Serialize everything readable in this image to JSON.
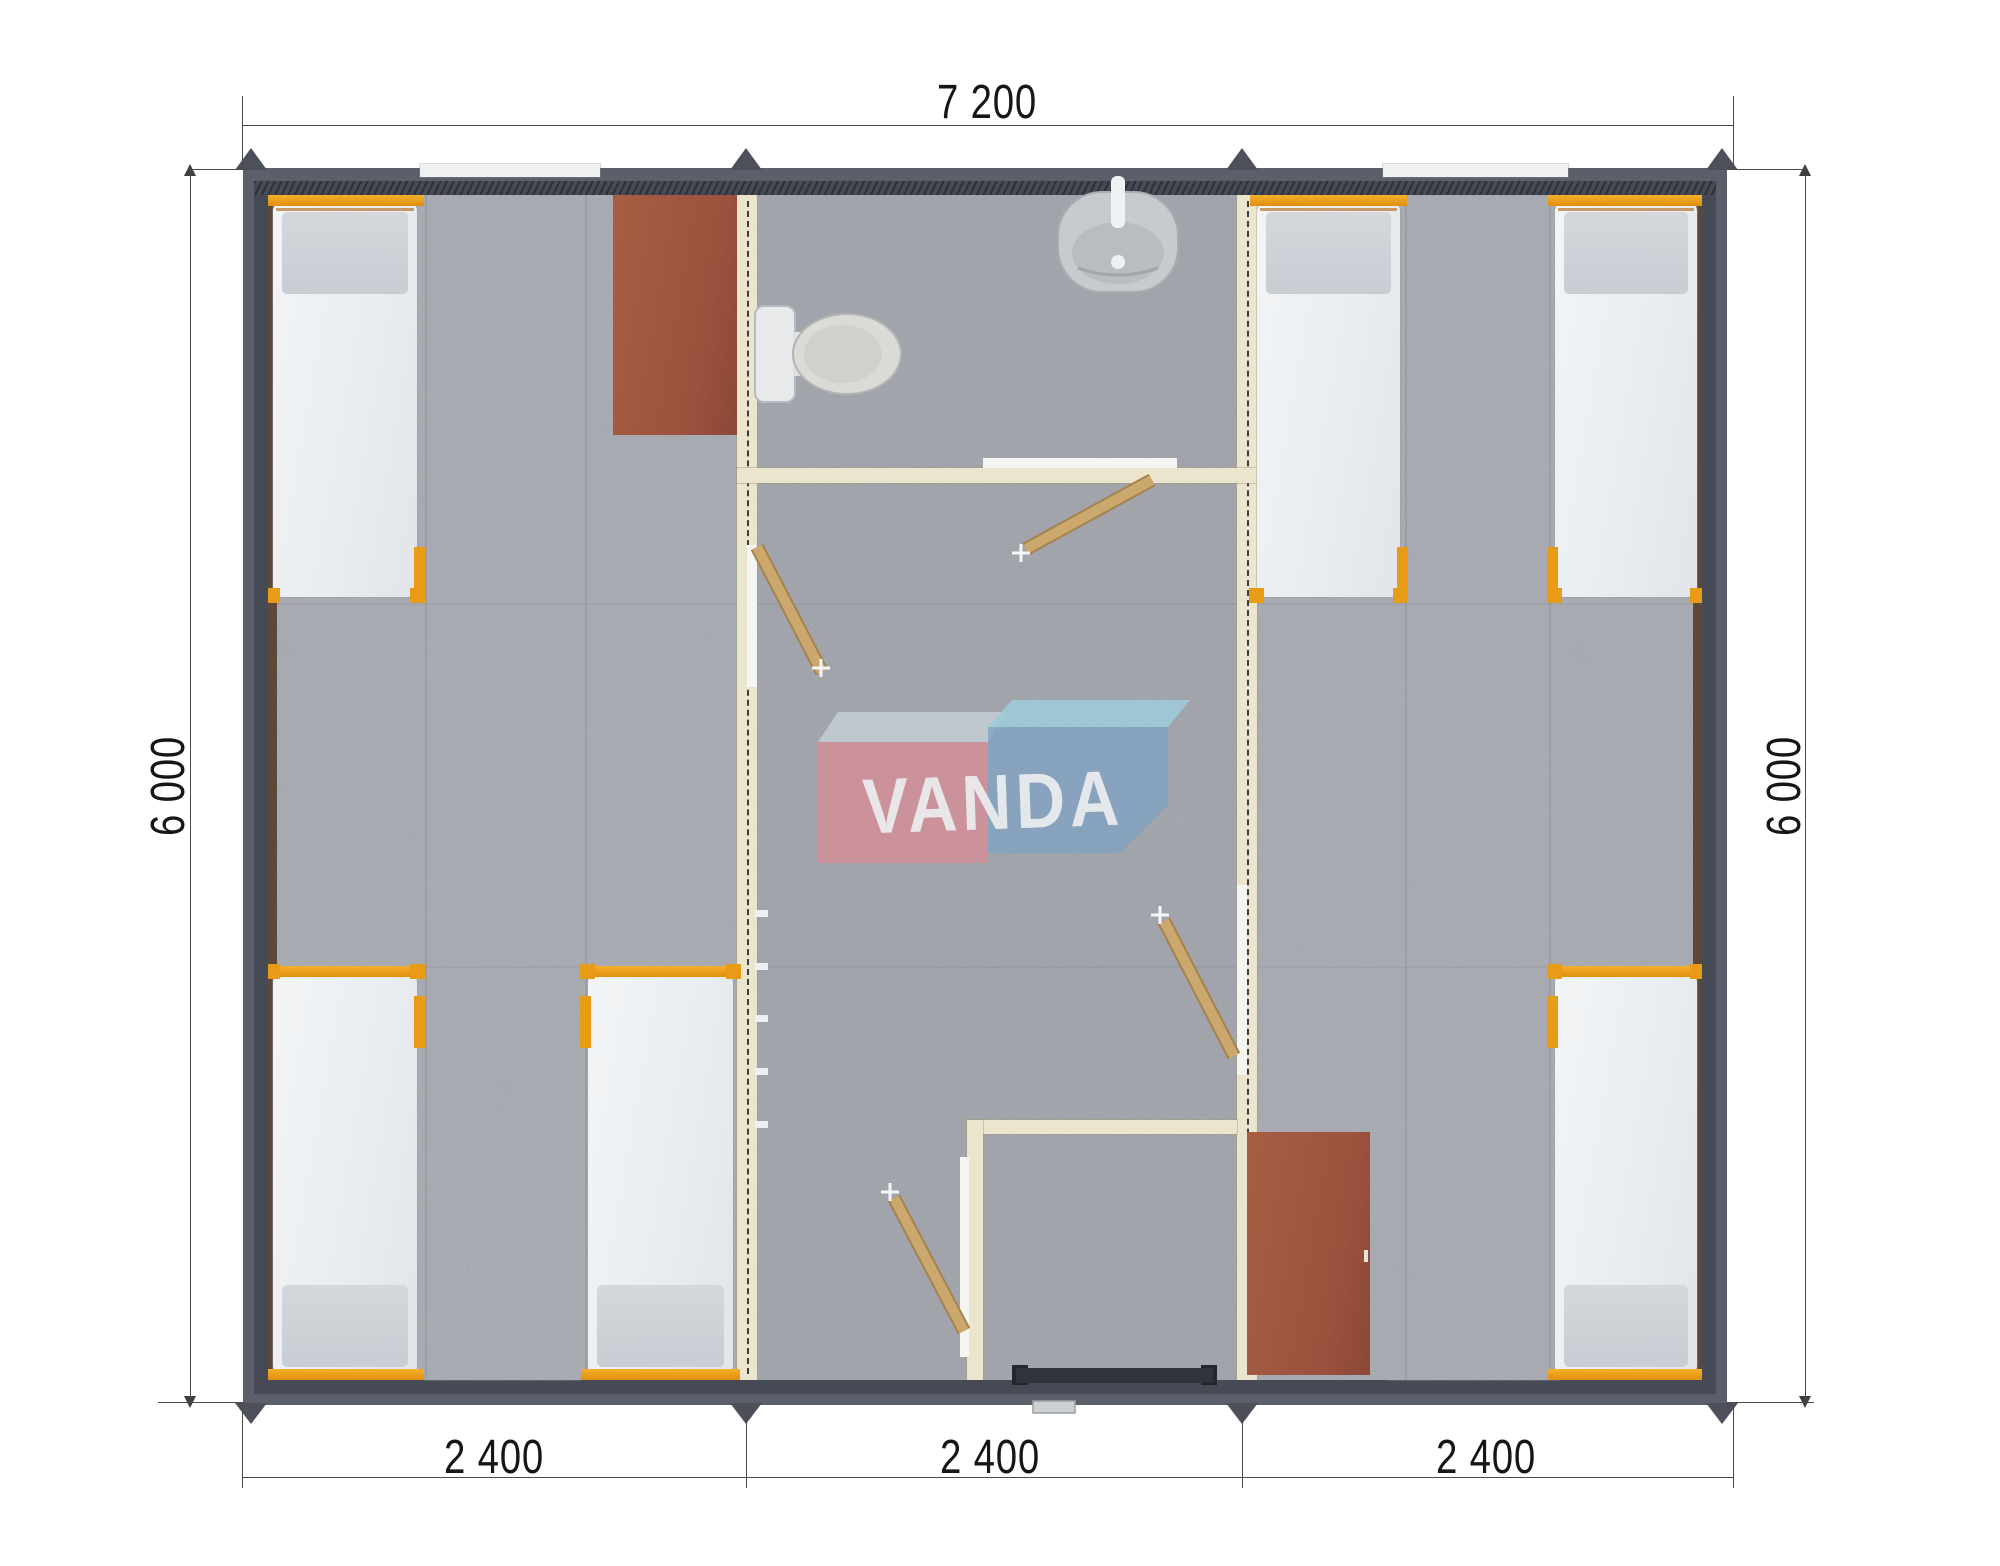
{
  "page": {
    "type": "architectural-floor-plan-top-view",
    "background": "#ffffff"
  },
  "dimensions": {
    "top_width": "7 200",
    "left_height": "6 000",
    "right_height": "6 000",
    "bottom_segments": [
      {
        "label": "2 400"
      },
      {
        "label": "2 400"
      },
      {
        "label": "2 400"
      }
    ]
  },
  "watermark": {
    "text": "VANDA",
    "red_box_color": "#dd8e99",
    "blue_box_color": "#7fa5c8",
    "blue_top_face_color": "#9ed3e6",
    "grey_top_face_color": "#cdd8de",
    "text_color": "#f9fbfc"
  },
  "colors": {
    "wall_outer": "#5a5f69",
    "wall_inner": "#454a54",
    "floor": "#a7aab0",
    "partition_cream": "#ece5cd",
    "bed_frame_orange": "#e89b16",
    "mattress_white": "#eef0f2",
    "pillow_grey": "#ccd1d7",
    "furniture_brown": "#9a523e",
    "door_wood": "#c8a266",
    "fixture_grey": "#d9dbd7",
    "dimension_ink": "#161616"
  },
  "fixtures": {
    "bed_count": 6,
    "wardrobe_count": 2,
    "toilet_count": 1,
    "sink_count": 1,
    "interior_door_count": 4,
    "entrance_door_count": 1,
    "module_count": 3
  }
}
